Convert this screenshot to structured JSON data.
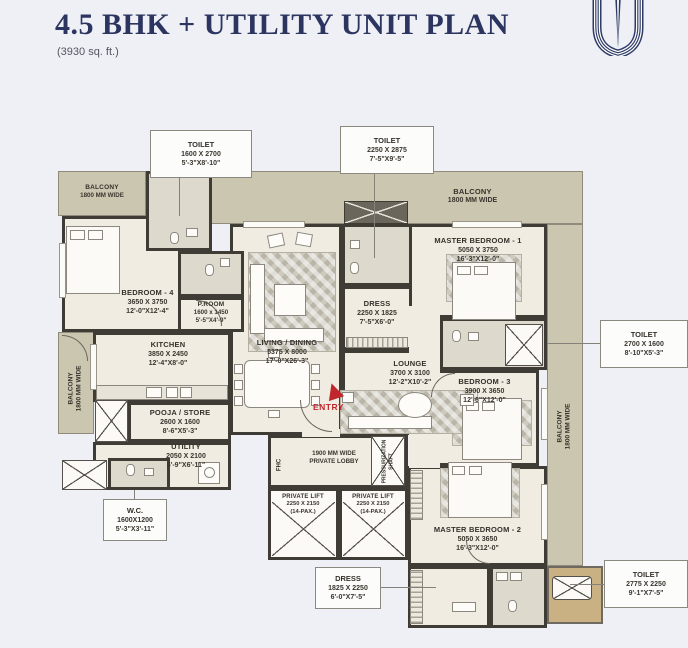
{
  "page": {
    "title": "4.5 BHK + UTILITY UNIT PLAN",
    "subtitle": "(3930 sq. ft.)"
  },
  "colors": {
    "page_bg": "#eef0f6",
    "wall": "#3f3b35",
    "floor": "#f0ece2",
    "wet_floor": "#ded9cd",
    "balcony": "#cbc6af",
    "accent_gold": "#c9b184",
    "title_navy": "#2c3560",
    "entry_red": "#c0272d"
  },
  "balcony": {
    "name": "BALCONY",
    "size": "1800 MM WIDE"
  },
  "rooms": {
    "bedroom4": {
      "name": "BEDROOM - 4",
      "mm": "3650 X 3750",
      "ft": "12'-0\"X12'-4\""
    },
    "proom": {
      "name": "P.ROOM",
      "mm": "1600 x 1450",
      "ft": "5'-5\"X4'-9\""
    },
    "kitchen": {
      "name": "KITCHEN",
      "mm": "3850 X 2450",
      "ft": "12'-4\"X8'-0\""
    },
    "pooja": {
      "name": "POOJA / STORE",
      "mm": "2600 X 1600",
      "ft": "8'-6\"X5'-3\""
    },
    "utility": {
      "name": "UTILITY",
      "mm": "2050 X 2100",
      "ft": "6'-9\"X6'-11\""
    },
    "living": {
      "name": "LIVING / DINING",
      "mm": "5375 X 8000",
      "ft": "17'-0\"X26'-3\""
    },
    "dress_c": {
      "name": "DRESS",
      "mm": "2250 X 1825",
      "ft": "7'-5\"X6'-0\""
    },
    "lounge": {
      "name": "LOUNGE",
      "mm": "3700 X 3100",
      "ft": "12'-2\"X10'-2\""
    },
    "mb1": {
      "name": "MASTER BEDROOM - 1",
      "mm": "5050 X 3750",
      "ft": "16'-3\"X12'-0\""
    },
    "bedroom3": {
      "name": "BEDROOM - 3",
      "mm": "3900 X 3650",
      "ft": "12'-6\"X12'-0\""
    },
    "mb2": {
      "name": "MASTER BEDROOM - 2",
      "mm": "5050 X 3650",
      "ft": "16'-3\"X12'-0\""
    }
  },
  "callouts": {
    "toilet_tl": {
      "name": "TOILET",
      "mm": "1600 X 2700",
      "ft": "5'-3\"X8'-10\""
    },
    "toilet_tc": {
      "name": "TOILET",
      "mm": "2250 X 2875",
      "ft": "7'-5\"X9'-5\""
    },
    "toilet_r": {
      "name": "TOILET",
      "mm": "2700 X 1600",
      "ft": "8'-10\"X5'-3\""
    },
    "toilet_br": {
      "name": "TOILET",
      "mm": "2775 X 2250",
      "ft": "9'-1\"X7'-5\""
    },
    "wc": {
      "name": "W.C.",
      "mm": "1600X1200",
      "ft": "5'-3\"X3'-11\""
    },
    "dress_b": {
      "name": "DRESS",
      "mm": "1825 X 2250",
      "ft": "6'-0\"X7'-5\""
    }
  },
  "lobby": {
    "line1": "1900 MM WIDE",
    "line2": "PRIVATE LOBBY"
  },
  "lift": {
    "name": "PRIVATE LIFT",
    "mm": "2250 X 2150",
    "pax": "(14-PAX.)"
  },
  "services": {
    "fhc": "FHC",
    "shaft1": "PRESSURIZATION",
    "shaft2": "SHAFT"
  },
  "entry": {
    "label": "ENTRY"
  }
}
